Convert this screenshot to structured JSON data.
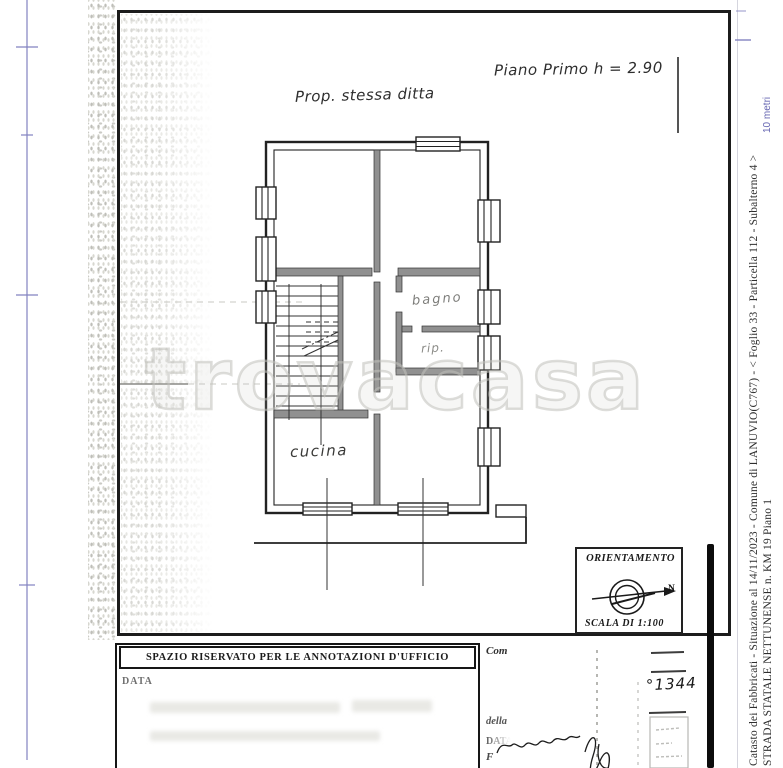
{
  "plan": {
    "property_note": "Prop. stessa ditta",
    "floor_note": "Piano Primo h = 2.90",
    "rooms": [
      {
        "label": "bagno"
      },
      {
        "label": "rip."
      },
      {
        "label": "cucina"
      }
    ],
    "orientation": {
      "title": "ORIENTAMENTO",
      "north_label": "N",
      "scale_label": "SCALA DI 1:100"
    }
  },
  "office_box": {
    "header": "SPAZIO RISERVATO PER LE ANNOTAZIONI D'UFFICIO",
    "date_label": "DATA"
  },
  "form": {
    "committente_label": "Com",
    "reference_number": "°1344",
    "della_label": "della",
    "date_label": "DATA",
    "firma_label": "F"
  },
  "margin": {
    "line1": "Catasto dei Fabbricati - Situazione al 14/11/2023 - Comune di LANUVIO(C767) - <  Foglio 33 - Particella  112 - Subalterno 4 >",
    "line2": "STRADA STATALE NETTUNENSE n. KM 19 Piano 1",
    "scale_note": "10 metri"
  },
  "watermark": "trovacasa"
}
